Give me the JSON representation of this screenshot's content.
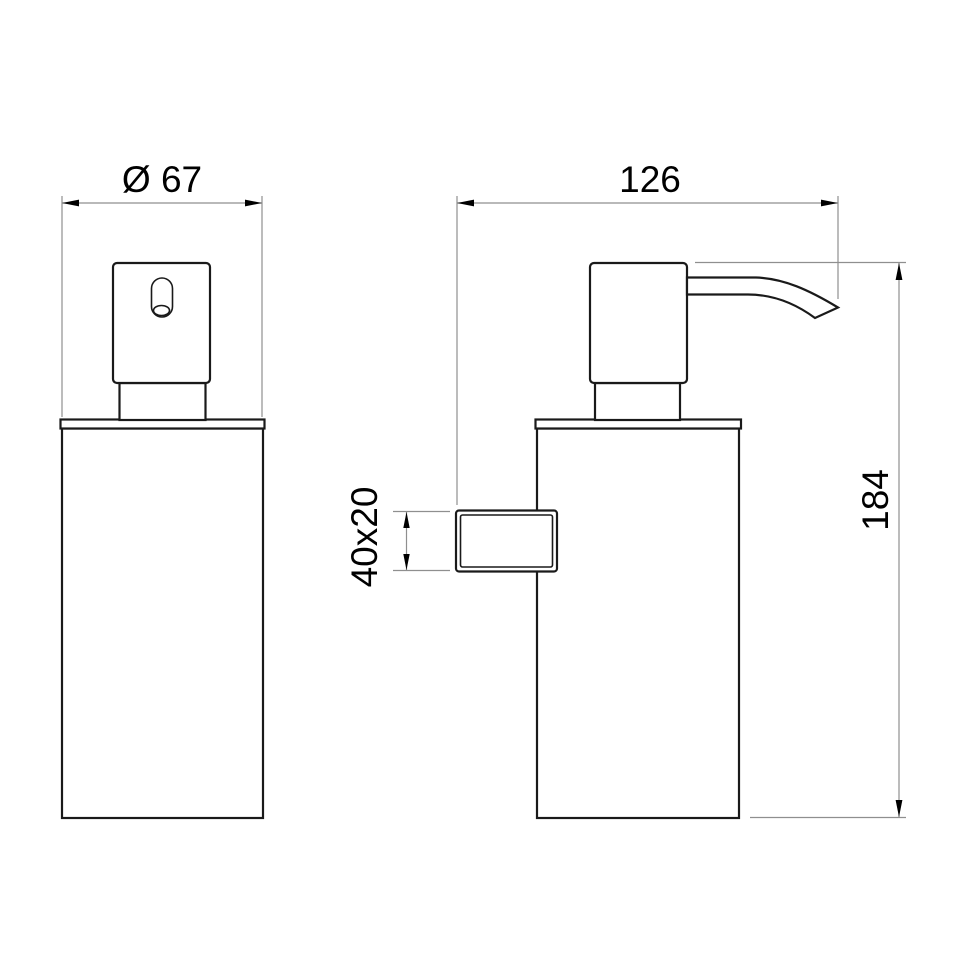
{
  "drawing": {
    "labels": {
      "diameter": "Ø 67",
      "depth": "126",
      "height": "184",
      "bracket": "40x20"
    },
    "colors": {
      "outline": "#1a1a1a",
      "dimension_lines": "#8f8f8f",
      "text": "#000000",
      "background": "#ffffff"
    }
  }
}
